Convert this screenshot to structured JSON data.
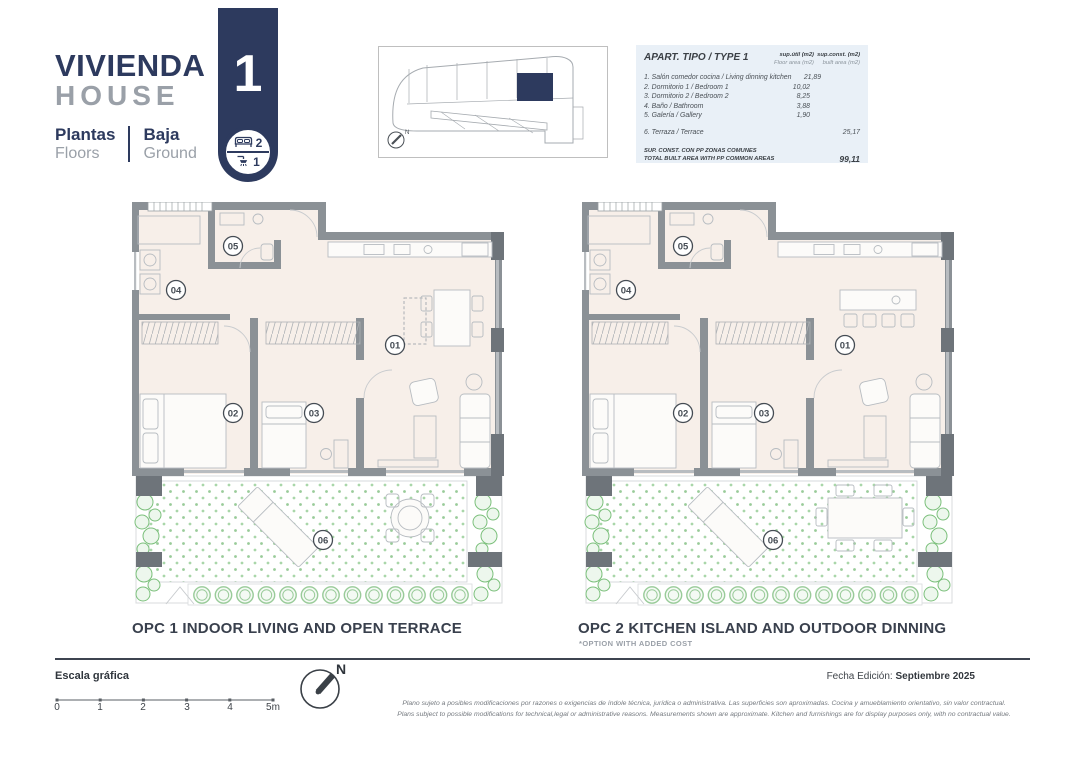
{
  "header": {
    "title_primary": "VIVIENDA",
    "title_secondary": "HOUSE",
    "unit_number": "1",
    "floors_label_primary": "Plantas",
    "floors_label_secondary": "Floors",
    "floor_value_primary": "Baja",
    "floor_value_secondary": "Ground",
    "bedrooms": "2",
    "bathrooms": "1"
  },
  "siteplan": {
    "north_label": "N"
  },
  "area_table": {
    "title": "APART. TIPO / TYPE 1",
    "columns": {
      "floor_area_line1": "sup.útil (m2)",
      "floor_area_line2": "Floor area (m2)",
      "built_area_line1": "sup.const. (m2)",
      "built_area_line2": "built area (m2)"
    },
    "rows": [
      {
        "label": "1. Salón comedor cocina / Living dinning kitchen",
        "floor_area": "21,89",
        "built_area": ""
      },
      {
        "label": "2. Dormitorio 1 / Bedroom 1",
        "floor_area": "10,02",
        "built_area": ""
      },
      {
        "label": "3. Dormitorio 2 / Bedroom 2",
        "floor_area": "8,25",
        "built_area": ""
      },
      {
        "label": "4. Baño / Bathroom",
        "floor_area": "3,88",
        "built_area": ""
      },
      {
        "label": "5. Galería / Gallery",
        "floor_area": "1,90",
        "built_area": ""
      },
      {
        "label": "6. Terraza / Terrace",
        "floor_area": "",
        "built_area": "25,17"
      }
    ],
    "total_label_line1": "SUP. CONST. CON PP ZONAS COMUNES",
    "total_label_line2": "TOTAL BUILT AREA WITH PP COMMON AREAS",
    "total_value": "99,11"
  },
  "plans": [
    {
      "caption": "OPC 1 INDOOR LIVING AND OPEN TERRACE",
      "subcaption": "",
      "room_labels": [
        "01",
        "02",
        "03",
        "04",
        "05",
        "06"
      ]
    },
    {
      "caption": "OPC 2 KITCHEN ISLAND AND OUTDOOR DINNING",
      "subcaption": "*OPTION WITH ADDED COST",
      "room_labels": [
        "01",
        "02",
        "03",
        "04",
        "05",
        "06"
      ]
    }
  ],
  "footer": {
    "scale_label": "Escala gráfica",
    "scale_ticks": [
      "0",
      "1",
      "2",
      "3",
      "4",
      "5m"
    ],
    "north_label": "N",
    "edition_label": "Fecha Edición:",
    "edition_value": "Septiembre 2025",
    "disclaimer_primary": "Plano sujeto a posibles modificaciones por razones o exigencias de índole técnica, jurídica o administrativa. Las superficies son aproximadas. Cocina y amueblamiento orientativo, sin valor contractual.",
    "disclaimer_secondary": "Plans subject to possible modifications for technical,legal or administrative reasons. Measurements shown are approximate. Kitchen and furnishings are for display purposes only, with no contractual value."
  },
  "colors": {
    "navy": "#2d3a5e",
    "gray_text": "#9aa0a8",
    "floor_fill": "#f7efe9",
    "wall_gray": "#8b9196",
    "table_bg": "#e9f0f7",
    "terrace_dot_green": "#99cb99",
    "caption_dark": "#39404d"
  }
}
